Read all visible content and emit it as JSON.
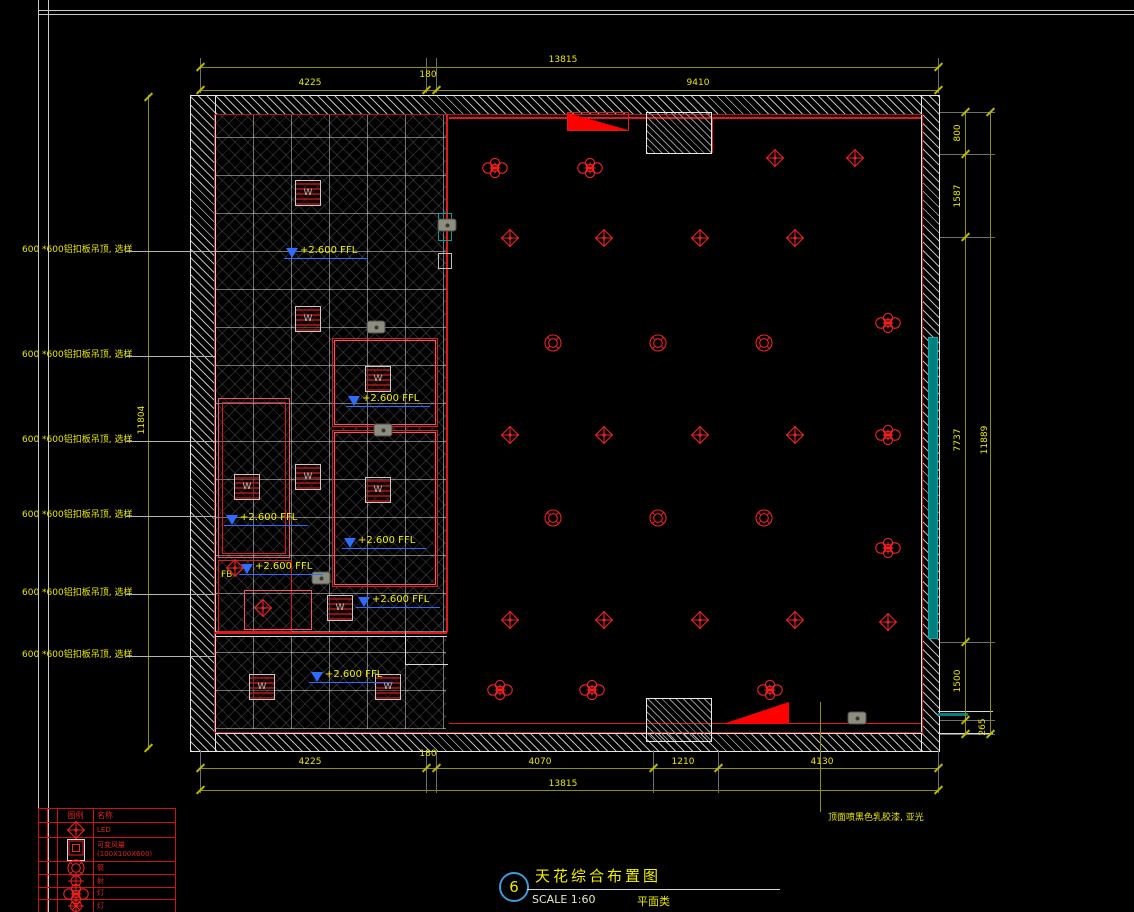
{
  "title_block": {
    "number": "6",
    "title": "天花综合布置图",
    "scale_label": "SCALE 1:60",
    "category_label": "平面类"
  },
  "annotations": {
    "ffl_text": "+2.600 FFL",
    "ffl_points": [
      {
        "x": 300,
        "y": 245
      },
      {
        "x": 362,
        "y": 393
      },
      {
        "x": 240,
        "y": 512
      },
      {
        "x": 358,
        "y": 535
      },
      {
        "x": 255,
        "y": 561
      },
      {
        "x": 372,
        "y": 594
      },
      {
        "x": 325,
        "y": 669
      }
    ],
    "left_notes": [
      {
        "text": "600 *600铝扣板吊顶, 选样",
        "y": 247
      },
      {
        "text": "600 *600铝扣板吊顶, 选样",
        "y": 352
      },
      {
        "text": "600 *600铝扣板吊顶, 选样",
        "y": 437
      },
      {
        "text": "600 *600铝扣板吊顶, 选样",
        "y": 512
      },
      {
        "text": "600 *600铝扣板吊顶, 选样",
        "y": 590
      },
      {
        "text": "600 *600铝扣板吊顶, 选样",
        "y": 652
      }
    ],
    "fb_label": "FB",
    "right_note": "顶面喷黑色乳胶漆, 亚光"
  },
  "dimensions": {
    "labels": [
      {
        "text": "13815",
        "x": 563,
        "y": 60
      },
      {
        "text": "4225",
        "x": 310,
        "y": 83
      },
      {
        "text": "180",
        "x": 428,
        "y": 75
      },
      {
        "text": "9410",
        "x": 698,
        "y": 83
      },
      {
        "text": "4225",
        "x": 310,
        "y": 762
      },
      {
        "text": "180",
        "x": 428,
        "y": 754
      },
      {
        "text": "4070",
        "x": 540,
        "y": 762
      },
      {
        "text": "1210",
        "x": 683,
        "y": 762
      },
      {
        "text": "4130",
        "x": 822,
        "y": 762
      },
      {
        "text": "13815",
        "x": 563,
        "y": 784
      },
      {
        "text": "800",
        "x": 958,
        "y": 133,
        "v": 1
      },
      {
        "text": "1587",
        "x": 958,
        "y": 196,
        "v": 1
      },
      {
        "text": "7737",
        "x": 958,
        "y": 440,
        "v": 1
      },
      {
        "text": "1500",
        "x": 958,
        "y": 681,
        "v": 1
      },
      {
        "text": "265",
        "x": 983,
        "y": 727,
        "v": 1
      },
      {
        "text": "11889",
        "x": 985,
        "y": 440,
        "v": 1
      },
      {
        "text": "11804",
        "x": 142,
        "y": 420,
        "v": 1
      }
    ],
    "ticks_h": [
      [
        200,
        67
      ],
      [
        938,
        67
      ],
      [
        200,
        90
      ],
      [
        426,
        90
      ],
      [
        436,
        90
      ],
      [
        938,
        90
      ],
      [
        200,
        768
      ],
      [
        426,
        768
      ],
      [
        436,
        768
      ],
      [
        653,
        768
      ],
      [
        718,
        768
      ],
      [
        938,
        768
      ],
      [
        200,
        790
      ],
      [
        938,
        790
      ]
    ],
    "ticks_v": [
      [
        965,
        112
      ],
      [
        965,
        154
      ],
      [
        965,
        237
      ],
      [
        965,
        642
      ],
      [
        965,
        720
      ],
      [
        965,
        734
      ],
      [
        990,
        112
      ],
      [
        990,
        734
      ],
      [
        148,
        97
      ],
      [
        148,
        748
      ]
    ]
  },
  "legend": {
    "header": [
      "图例",
      "名称"
    ],
    "rows": [
      {
        "sym": "diamond",
        "label": "LED"
      },
      {
        "sym": "diffuser",
        "label": "可变风量",
        "label2": "(100X100X600)"
      },
      {
        "sym": "round",
        "label": "筒"
      },
      {
        "sym": "crosshair",
        "label": "射"
      },
      {
        "sym": "flower",
        "label": "灯"
      },
      {
        "sym": "target",
        "label": "灯"
      }
    ]
  },
  "symbols": {
    "flower_lights": [
      [
        495,
        168
      ],
      [
        590,
        168
      ],
      [
        888,
        323
      ],
      [
        888,
        435
      ],
      [
        888,
        548
      ],
      [
        500,
        690
      ],
      [
        592,
        690
      ],
      [
        770,
        690
      ]
    ],
    "diamond_lights": [
      [
        775,
        158
      ],
      [
        855,
        158
      ],
      [
        510,
        238
      ],
      [
        604,
        238
      ],
      [
        700,
        238
      ],
      [
        795,
        238
      ],
      [
        510,
        435
      ],
      [
        604,
        435
      ],
      [
        700,
        435
      ],
      [
        795,
        435
      ],
      [
        510,
        620
      ],
      [
        604,
        620
      ],
      [
        700,
        620
      ],
      [
        795,
        620
      ],
      [
        888,
        622
      ],
      [
        235,
        568
      ],
      [
        263,
        608
      ]
    ],
    "round_lights": [
      [
        553,
        343
      ],
      [
        658,
        343
      ],
      [
        764,
        343
      ],
      [
        553,
        518
      ],
      [
        658,
        518
      ],
      [
        764,
        518
      ]
    ],
    "diffusers": [
      [
        308,
        193
      ],
      [
        308,
        319
      ],
      [
        378,
        379
      ],
      [
        378,
        490
      ],
      [
        247,
        487
      ],
      [
        308,
        477
      ],
      [
        340,
        608
      ],
      [
        262,
        687
      ],
      [
        388,
        687
      ]
    ],
    "speakers": [
      [
        376,
        327
      ],
      [
        383,
        430
      ],
      [
        321,
        578
      ],
      [
        447,
        225
      ],
      [
        857,
        718
      ]
    ]
  }
}
